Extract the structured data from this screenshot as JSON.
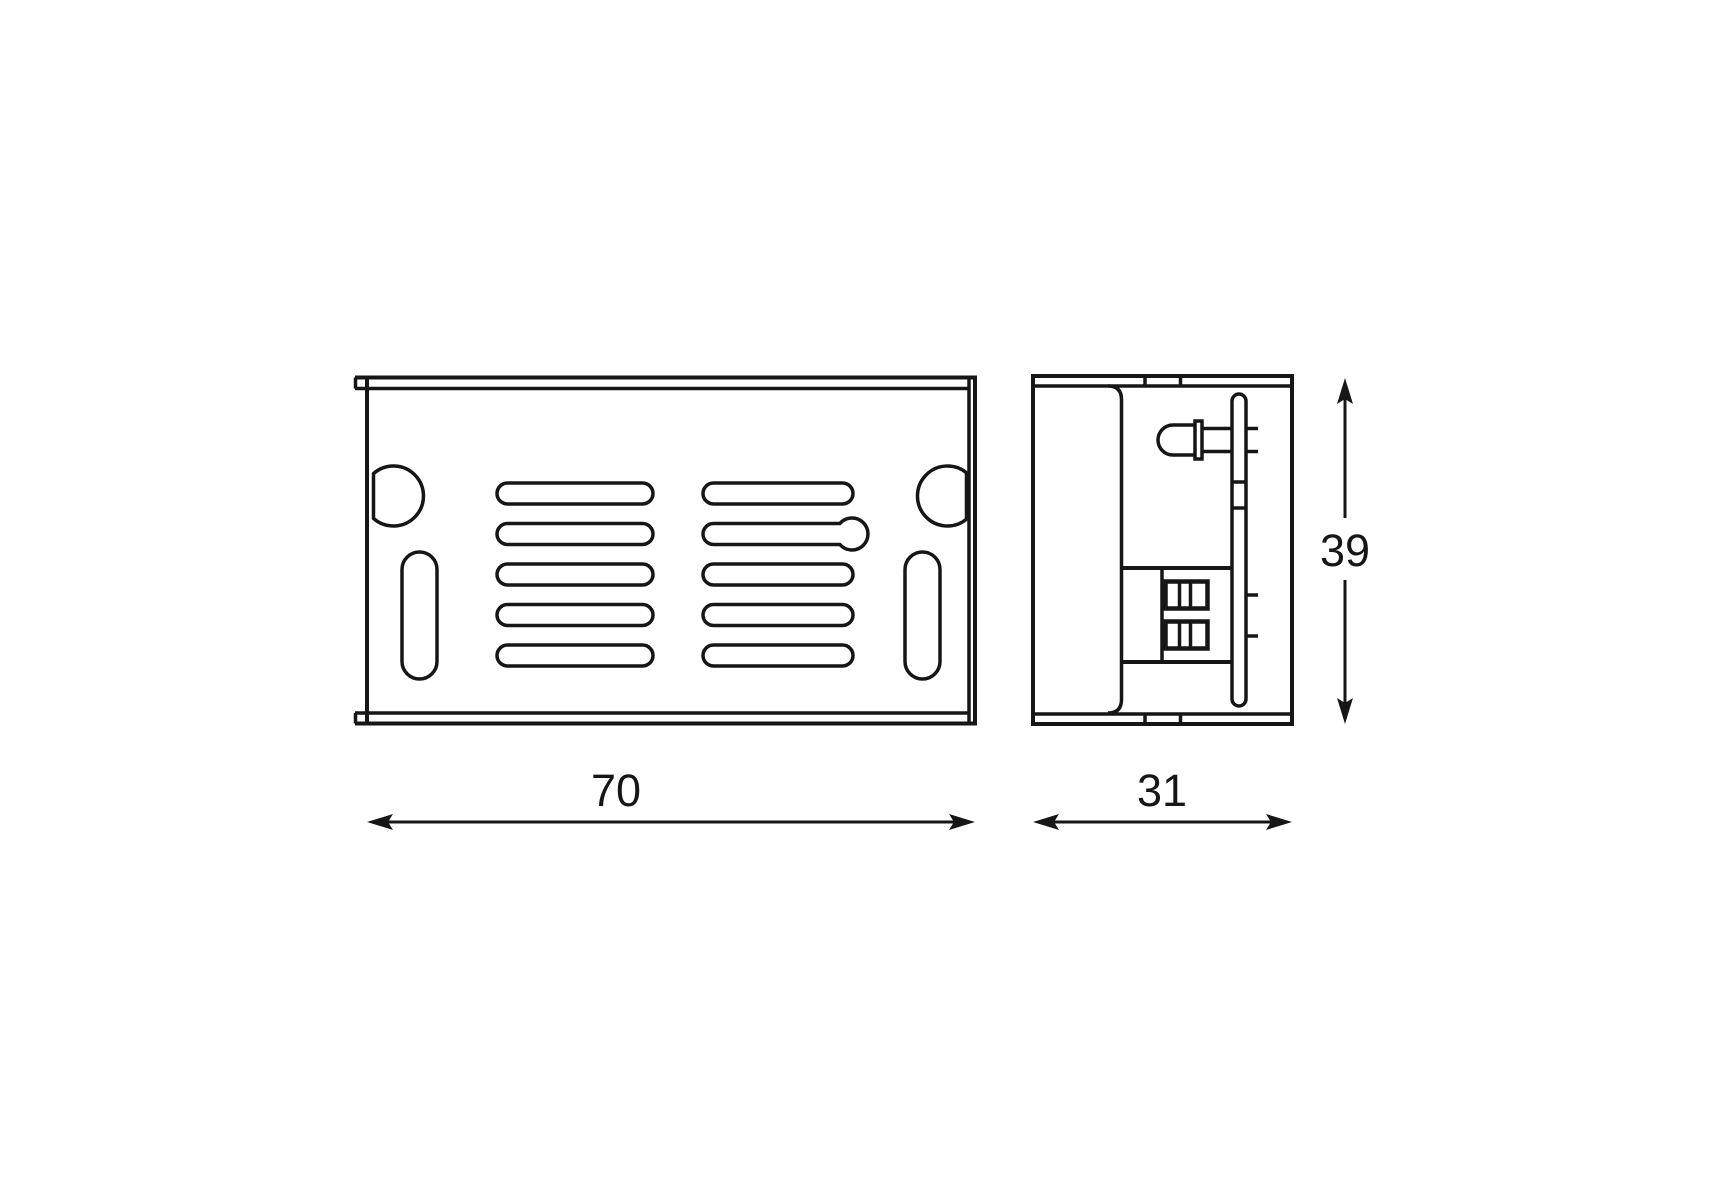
{
  "colors": {
    "background": "#ffffff",
    "line": "#161616"
  },
  "dimensions": {
    "top_view_width": "70",
    "side_view_depth": "31",
    "side_view_height": "39"
  }
}
